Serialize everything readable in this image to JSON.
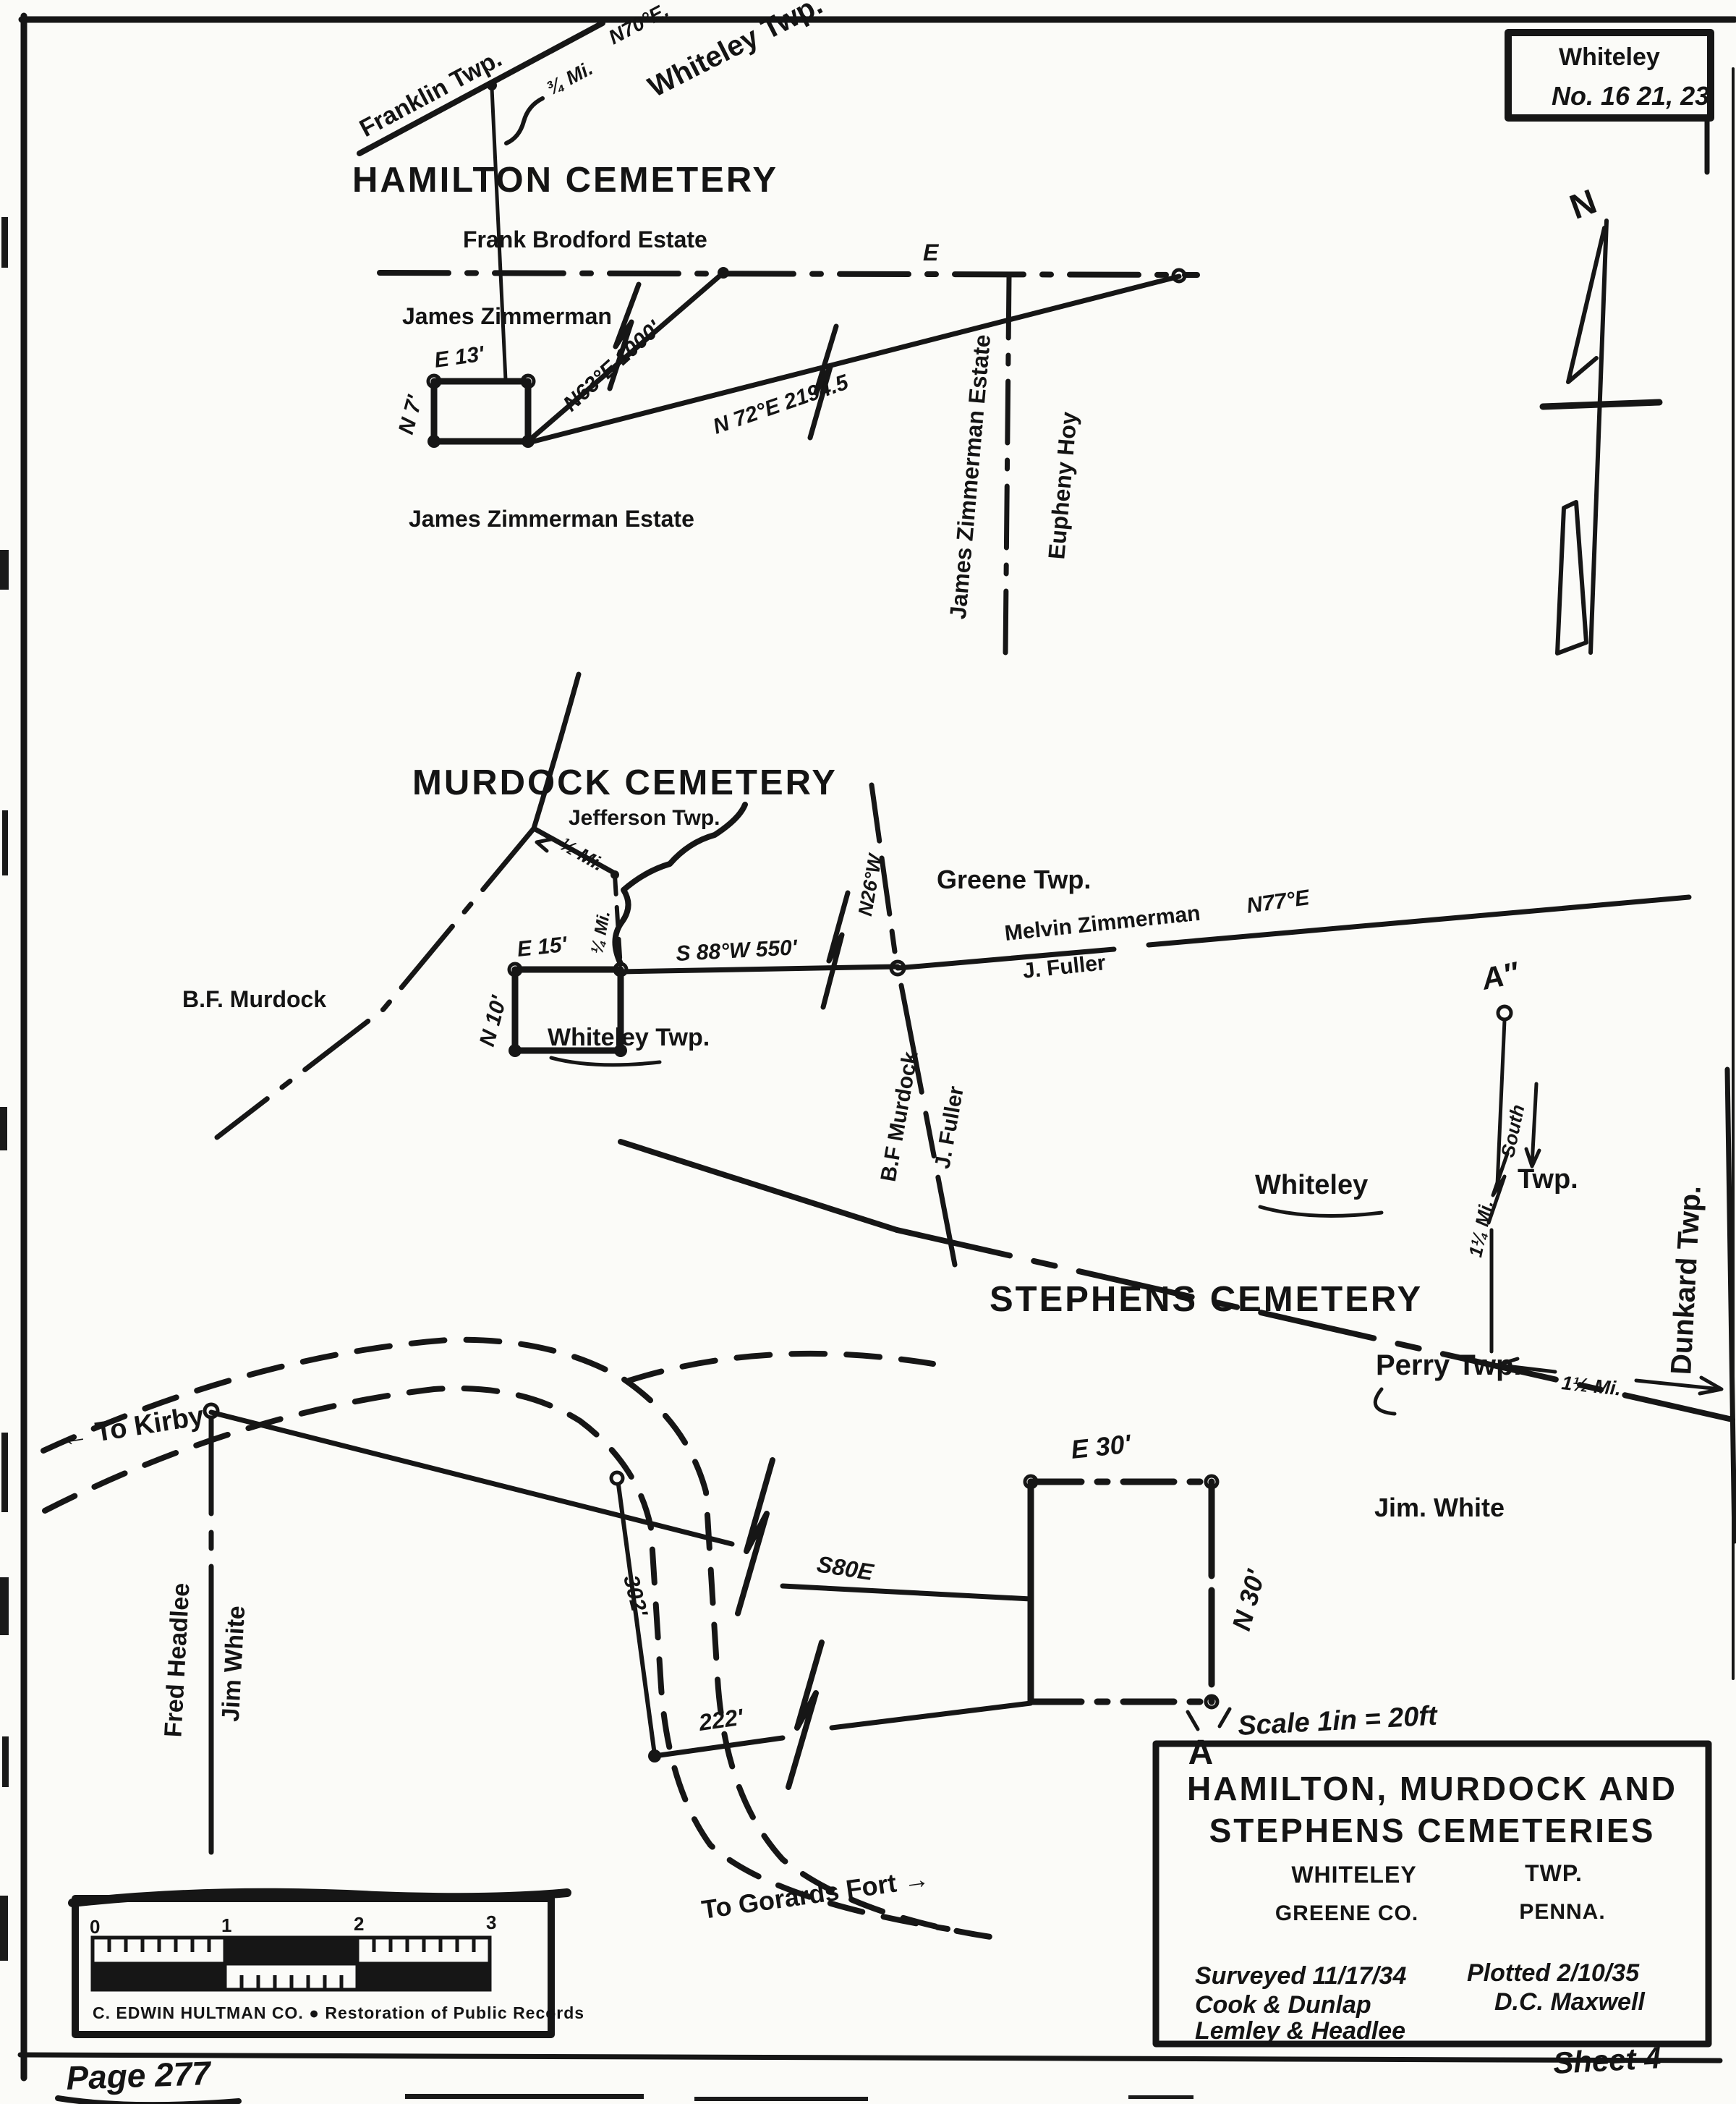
{
  "page": {
    "ref_box": {
      "line1": "Whiteley",
      "line2": "No. 16 21, 23"
    },
    "page_number": "Page 277",
    "sheet_label": "Sheet 4",
    "compass_north": "N",
    "stamp": {
      "numbers": [
        "0",
        "1",
        "2",
        "3"
      ],
      "caption": "C. EDWIN HULTMAN CO.  ●  Restoration of Public Records"
    }
  },
  "hamilton": {
    "title": "HAMILTON CEMETERY",
    "franklin_twp": "Franklin Twp.",
    "whiteley_twp": "Whiteley Twp.",
    "bearing_n70e": "N70°E.",
    "three_quarter_mi": "¾ Mi.",
    "frank_brodford_estate": "Frank Brodford Estate",
    "james_zimmerman": "James Zimmerman",
    "e_label": "E",
    "plot_e": "E 13'",
    "plot_n": "N 7'",
    "bearing_n63e": "N63°E 1000'",
    "bearing_n72e": "N 72°E  2194.5",
    "james_zimmerman_estate": "James Zimmerman Estate",
    "james_zimmerman_estate_vert": "James Zimmerman Estate",
    "eupheny_hoy": "Eupheny Hoy"
  },
  "murdock": {
    "title": "MURDOCK CEMETERY",
    "jefferson_twp": "Jefferson Twp.",
    "greene_twp": "Greene Twp.",
    "whiteley_twp": "Whiteley Twp.",
    "half_mi": "½ Mi.",
    "quarter_mi": "¼ Mi.",
    "bf_murdock": "B.F. Murdock",
    "plot_e": "E 15'",
    "plot_n": "N 10'",
    "bearing_s88w": "S 88°W  550'",
    "bearing_n26w": "N26°W",
    "melvin_zimmerman": "Melvin Zimmerman",
    "bearing_n77e": "N77°E",
    "j_fuller_road": "J. Fuller",
    "bf_murdock_vert": "B.F Murdock",
    "j_fuller_vert": "J. Fuller"
  },
  "stephens": {
    "title": "STEPHENS CEMETERY",
    "a_ref": "A″",
    "mi_south_1": "1¼ Mi.",
    "mi_south_2": "South",
    "whiteley": "Whiteley",
    "twp": "Twp.",
    "perry_twp": "Perry  Twp.",
    "dunkard_twp": "Dunkard  Twp.",
    "one_half_mi": "1½ Mi."
  },
  "detail": {
    "to_kirby": "← To Kirby",
    "fred_headlee": "Fred Headlee",
    "jim_white_road": "Jim White",
    "dist_302": "302'",
    "bearing_s80e": "S80E",
    "dist_222": "222'",
    "plot_e": "E 30'",
    "plot_n": "N 30'",
    "jim_white": "Jim. White",
    "a_corner": "A",
    "to_gorards_fort": "To Gorards Fort →",
    "scale_note": "Scale 1in = 20ft"
  },
  "title_block": {
    "line1": "HAMILTON, MURDOCK AND",
    "line2": "STEPHENS   CEMETERIES",
    "twp_left": "WHITELEY",
    "twp_right": "TWP.",
    "co_left": "GREENE CO.",
    "co_right": "PENNA.",
    "surveyed": "Surveyed 11/17/34",
    "plotted": "Plotted 2/10/35",
    "surveyors_1": "Cook & Dunlap",
    "surveyors_2": "Lemley & Headlee",
    "plotter": "D.C. Maxwell"
  }
}
